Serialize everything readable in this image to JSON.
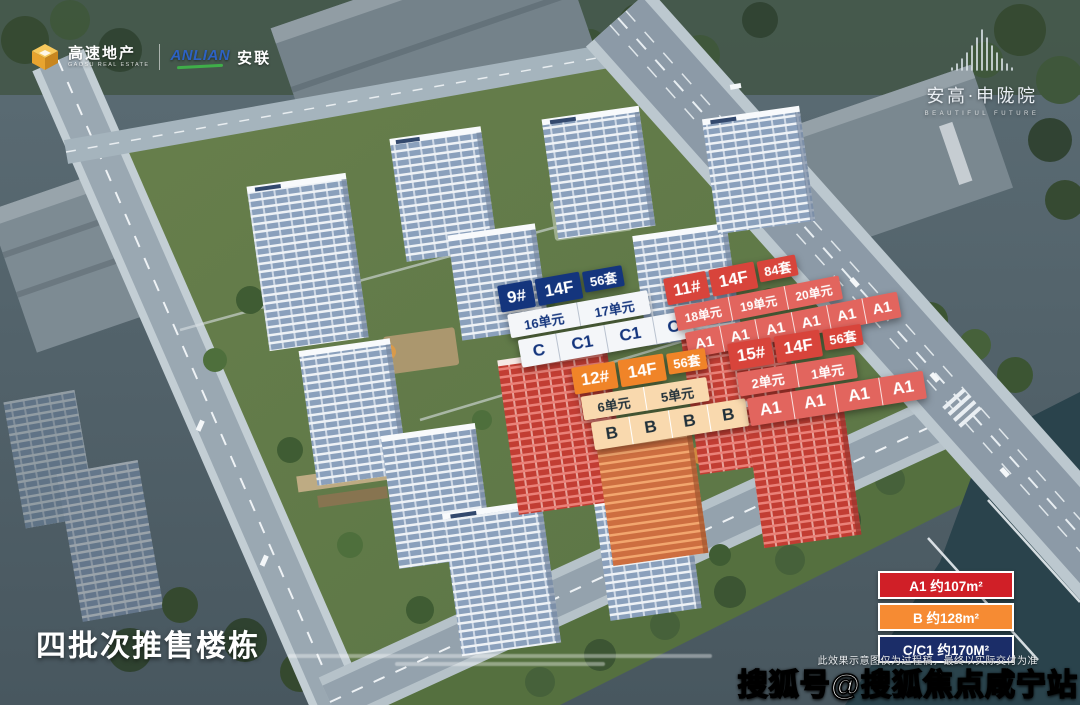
{
  "brand_left": {
    "name_cn": "高速地产",
    "name_en": "GAOSU REAL ESTATE",
    "cube_icon": "isometric-cube",
    "cube_color": "#f2b33d",
    "partner_en": "ANLIAN",
    "partner_en_color": "#2d62c4",
    "partner_swoosh_color": "#3fae49",
    "partner_cn": "安联"
  },
  "brand_right": {
    "crown_icon": "building-crown",
    "name": "安高·申陇院",
    "tagline": "BEAUTIFUL FUTURE"
  },
  "building_labels": [
    {
      "no": "9#",
      "floors": "14F",
      "total": "56套",
      "theme": "navy",
      "units": [
        "16单元",
        "17单元"
      ],
      "types": [
        "C",
        "C1",
        "C1",
        "C"
      ]
    },
    {
      "no": "11#",
      "floors": "14F",
      "total": "84套",
      "theme": "red",
      "units": [
        "18单元",
        "19单元",
        "20单元"
      ],
      "types": [
        "A1",
        "A1",
        "A1",
        "A1",
        "A1",
        "A1"
      ]
    },
    {
      "no": "12#",
      "floors": "14F",
      "total": "56套",
      "theme": "orange",
      "units": [
        "6单元",
        "5单元"
      ],
      "types": [
        "B",
        "B",
        "B",
        "B"
      ]
    },
    {
      "no": "15#",
      "floors": "14F",
      "total": "56套",
      "theme": "red",
      "units": [
        "2单元",
        "1单元"
      ],
      "types": [
        "A1",
        "A1",
        "A1",
        "A1"
      ]
    }
  ],
  "label_theme_colors": {
    "navy": "#14357d",
    "red": "#d8443b",
    "orange": "#f08428"
  },
  "legend": {
    "items": [
      {
        "label": "A1 约107m²",
        "color": "#d01f27"
      },
      {
        "label": "B 约128m²",
        "color": "#f68b33"
      },
      {
        "label": "C/C1 约170M²",
        "color": "#1b2d68"
      }
    ]
  },
  "footer": {
    "batch_title": "四批次推售楼栋",
    "disclaimer": "此效果示意图仅为过程稿，最终以实际交付为准",
    "watermark": "搜狐号@搜狐焦点咸宁站"
  }
}
